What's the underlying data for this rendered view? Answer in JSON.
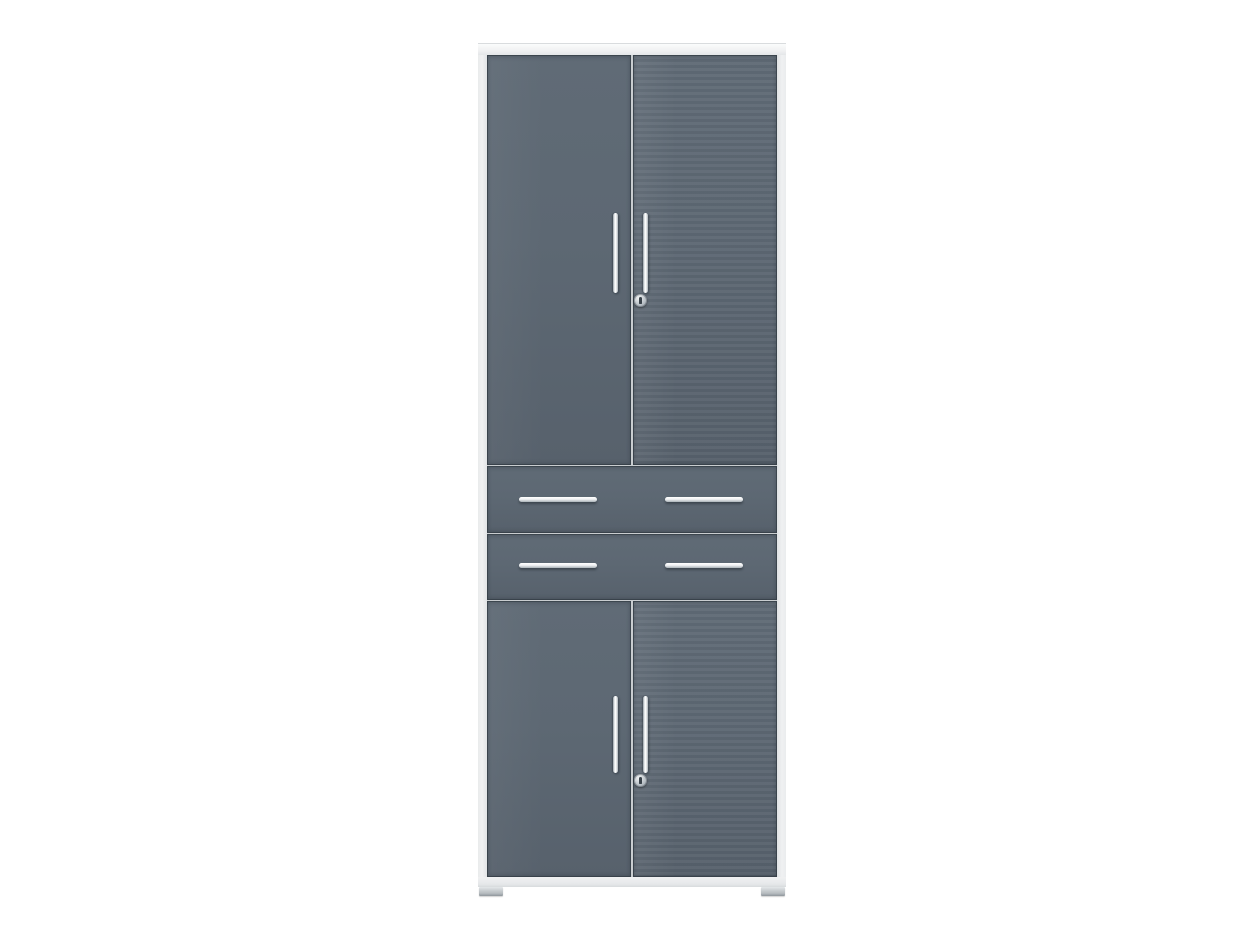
{
  "scene": {
    "type": "product-photo",
    "description": "Tall anthracite grey office cabinet with two upper doors, two centre drawers and two lower doors, light grey carcass, chrome bar handles, two cylinder locks and small glide feet, on a plain white background",
    "background_color": "#ffffff"
  },
  "colors": {
    "background": "#ffffff",
    "carcass": "#f0f1f2",
    "carcassShade": "#c9cdd0",
    "front": "#5d6873",
    "frontDeep": "#57616c",
    "edge": "#343d46",
    "chrome": "#ffffff",
    "chromeShade": "#aab2b8",
    "lockFace": "#bac1c7",
    "keyhole": "#39424a",
    "foot": "#b6bcc0"
  },
  "cabinet": {
    "sections": [
      {
        "name": "upper-doors",
        "doors": 2,
        "handle_style": "vertical chrome bar",
        "handles": 2,
        "lock": true
      },
      {
        "name": "drawer-row-1",
        "handle_style": "horizontal chrome bar",
        "handles": 2
      },
      {
        "name": "drawer-row-2",
        "handle_style": "horizontal chrome bar",
        "handles": 2
      },
      {
        "name": "lower-doors",
        "doors": 2,
        "handle_style": "vertical chrome bar",
        "handles": 2,
        "lock": true
      }
    ],
    "feet": 2,
    "front_finish": "glossy anthracite grey",
    "carcass_finish": "light grey"
  }
}
